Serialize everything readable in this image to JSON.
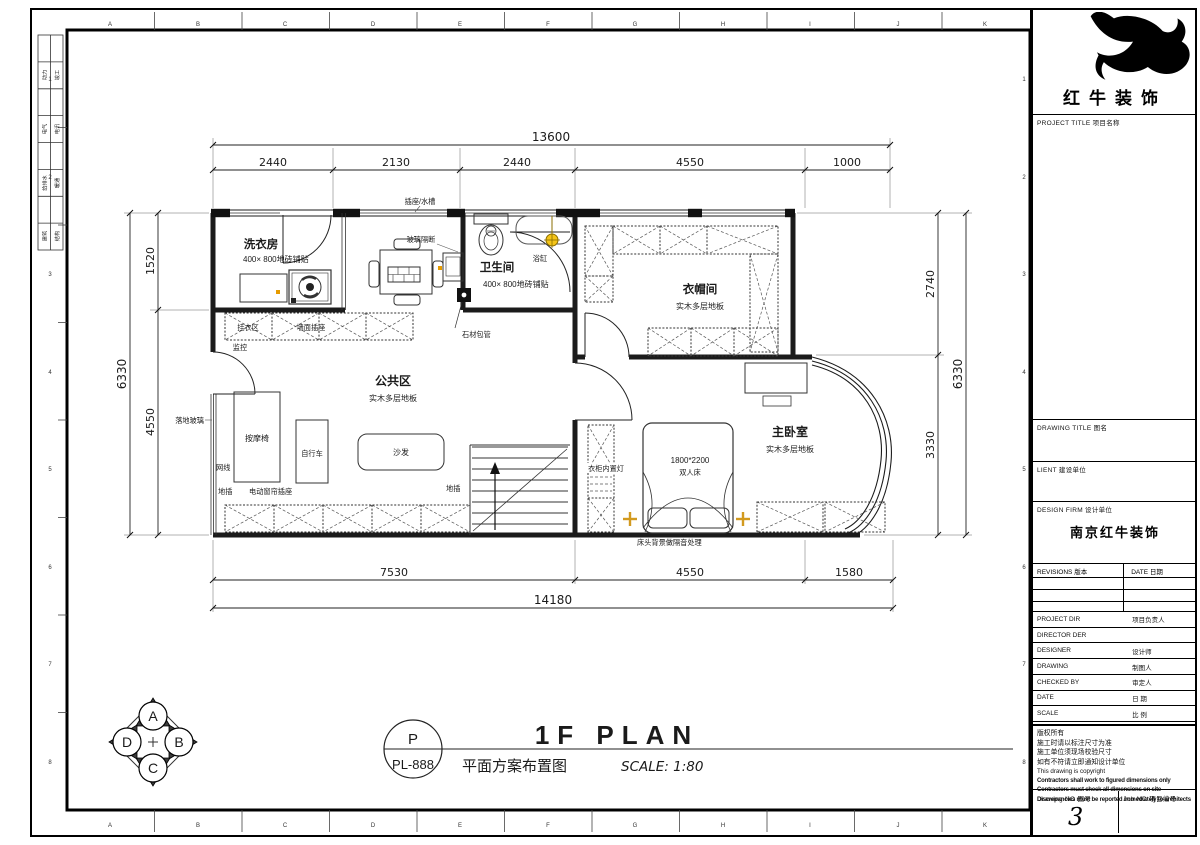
{
  "sheet": {
    "top_letters": [
      "A",
      "B",
      "C",
      "D",
      "E",
      "F",
      "G",
      "H",
      "I",
      "J",
      "K"
    ],
    "bottom_letters": [
      "A",
      "B",
      "C",
      "D",
      "E",
      "F",
      "G",
      "H",
      "I",
      "J",
      "K"
    ],
    "left_numbers": [
      "1",
      "2",
      "3",
      "4",
      "5",
      "6",
      "7",
      "8"
    ],
    "right_numbers": [
      "1",
      "2",
      "3",
      "4",
      "5",
      "6",
      "7",
      "8"
    ],
    "sign_table": [
      [
        "动力",
        "竣工"
      ],
      [
        "电气",
        "电讯"
      ],
      [
        "给排水",
        "暖通"
      ],
      [
        "建筑",
        "结构"
      ]
    ]
  },
  "plan": {
    "rooms": {
      "laundry": {
        "name": "洗衣房",
        "floor": "400× 800地砖铺贴"
      },
      "bathroom": {
        "name": "卫生间",
        "floor": "400× 800地砖铺贴"
      },
      "closet": {
        "name": "衣帽间",
        "floor": "实木多层地板"
      },
      "public": {
        "name": "公共区",
        "floor": "实木多层地板"
      },
      "bedroom": {
        "name": "主卧室",
        "floor": "实木多层地板"
      }
    },
    "annotations": {
      "socket_sink": "插座/水槽",
      "glass_partition": "玻璃隔断",
      "bathtub": "浴缸",
      "stone_pipe": "石材包管",
      "hanging_area": "挂衣区",
      "wall_socket": "墙面插座",
      "monitor": "监控",
      "floor_glass": "落地玻璃",
      "network": "网线",
      "floor_socket_left": "地插",
      "curtain_socket": "电动窗帘插座",
      "floor_socket_right": "地插",
      "massage_chair": "按摩椅",
      "bicycle": "自行车",
      "sofa": "沙发",
      "bed_size": "1800*2200",
      "bed_type": "双人床",
      "wardrobe_light": "衣柜内置灯",
      "headboard_note": "床头背景做隔音处理"
    },
    "dims": {
      "top_total": "13600",
      "top_segments": [
        "2440",
        "2130",
        "2440",
        "4550",
        "1000"
      ],
      "bottom_segments": [
        "7530",
        "4550",
        "1580"
      ],
      "bottom_total": "14180",
      "left_segments": [
        "1520",
        "4550"
      ],
      "left_total": "6330",
      "right_segments": [
        "2740",
        "3330"
      ],
      "right_total": "6330"
    },
    "titlebar": {
      "code_top": "P",
      "code_bottom": "PL-888",
      "main": "1F PLAN",
      "cn": "平面方案布置图",
      "scale": "SCALE: 1:80"
    },
    "compass": {
      "top": "A",
      "right": "B",
      "bottom": "C",
      "left": "D"
    }
  },
  "title_block": {
    "company": "红牛装饰",
    "project_title": "PROJECT TITLE  项目名称",
    "drawing_title": "DRAWING TITLE  图名",
    "client": "LIENT  建设单位",
    "design_firm": "DESIGN FIRM  设计单位",
    "design_firm_value": "南京红牛装饰",
    "revisions": "REVISIONS  版本",
    "date_col": "DATE  日期",
    "rows": [
      {
        "en": "PROJECT DIR",
        "cn": "项目负责人"
      },
      {
        "en": "DIRECTOR DER",
        "cn": ""
      },
      {
        "en": "DESIGNER",
        "cn": "设计师"
      },
      {
        "en": "DRAWING",
        "cn": "制图人"
      },
      {
        "en": "CHECKED BY",
        "cn": "审定人"
      },
      {
        "en": "DATE",
        "cn": "日 期"
      },
      {
        "en": "SCALE",
        "cn": "比 例"
      }
    ],
    "notes_cn": [
      "版权所有",
      "施工时请以标注尺寸为准",
      "施工单位须现场校验尺寸",
      "如有不符请立即通知设计单位"
    ],
    "notes_en_light": "This drawing is copyright",
    "notes_en_bold": [
      "Contractors shall work to figured dimensions only",
      "Contractors must check all dimensions on site",
      "Discrepancies must be reported immediately to architects"
    ],
    "drawing_no_label": "Drawing NO  图号",
    "drawing_no_value": "3",
    "job_no_label": "Job NO  项目编号"
  }
}
